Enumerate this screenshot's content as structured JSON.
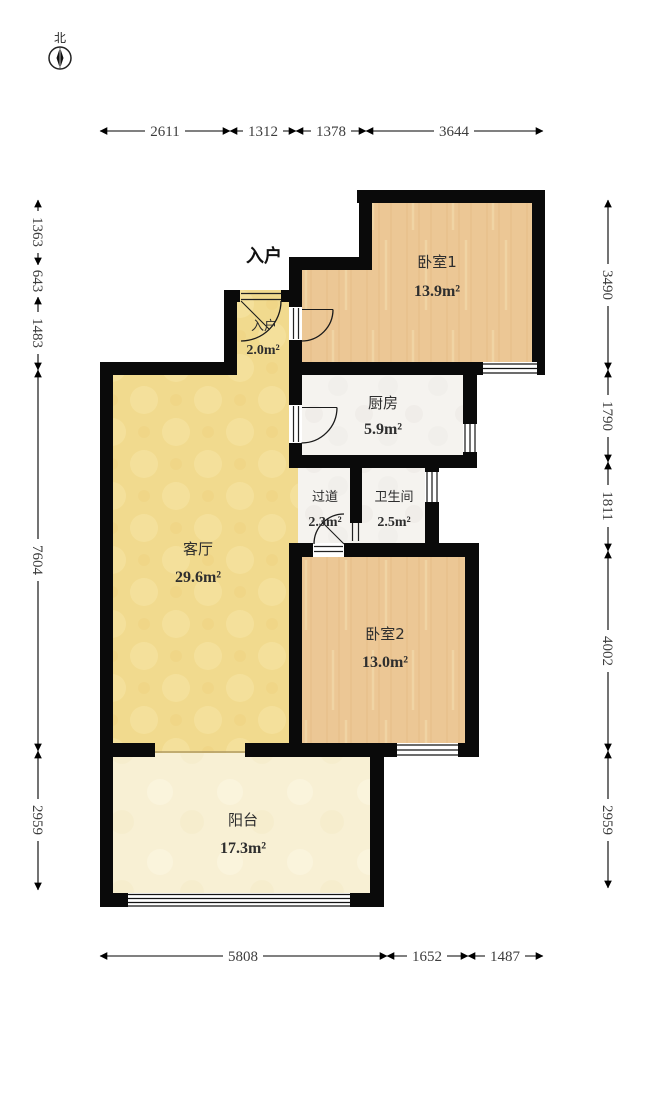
{
  "compass": {
    "north_label": "北"
  },
  "entrance_label": "入户",
  "rooms": [
    {
      "id": "bedroom1",
      "name": "卧室1",
      "area": "13.9m²"
    },
    {
      "id": "entry",
      "name": "入户",
      "area": "2.0m²"
    },
    {
      "id": "kitchen",
      "name": "厨房",
      "area": "5.9m²"
    },
    {
      "id": "hallway",
      "name": "过道",
      "area": "2.3m²"
    },
    {
      "id": "bathroom",
      "name": "卫生间",
      "area": "2.5m²"
    },
    {
      "id": "living",
      "name": "客厅",
      "area": "29.6m²"
    },
    {
      "id": "bedroom2",
      "name": "卧室2",
      "area": "13.0m²"
    },
    {
      "id": "balcony",
      "name": "阳台",
      "area": "17.3m²"
    }
  ],
  "dimensions": {
    "top": [
      "2611",
      "1312",
      "1378",
      "3644"
    ],
    "left": [
      "1363",
      "643",
      "1483",
      "7604",
      "2959"
    ],
    "right": [
      "3490",
      "1790",
      "1811",
      "4002",
      "2959"
    ],
    "bottom": [
      "5808",
      "1652",
      "1487"
    ]
  },
  "colors": {
    "wall": "#0a0a0a",
    "living_floor": "#f1da8e",
    "wood_floor": "#ecc795",
    "tile_floor": "#f5f3ef",
    "balcony_floor": "#f8f0d4"
  }
}
